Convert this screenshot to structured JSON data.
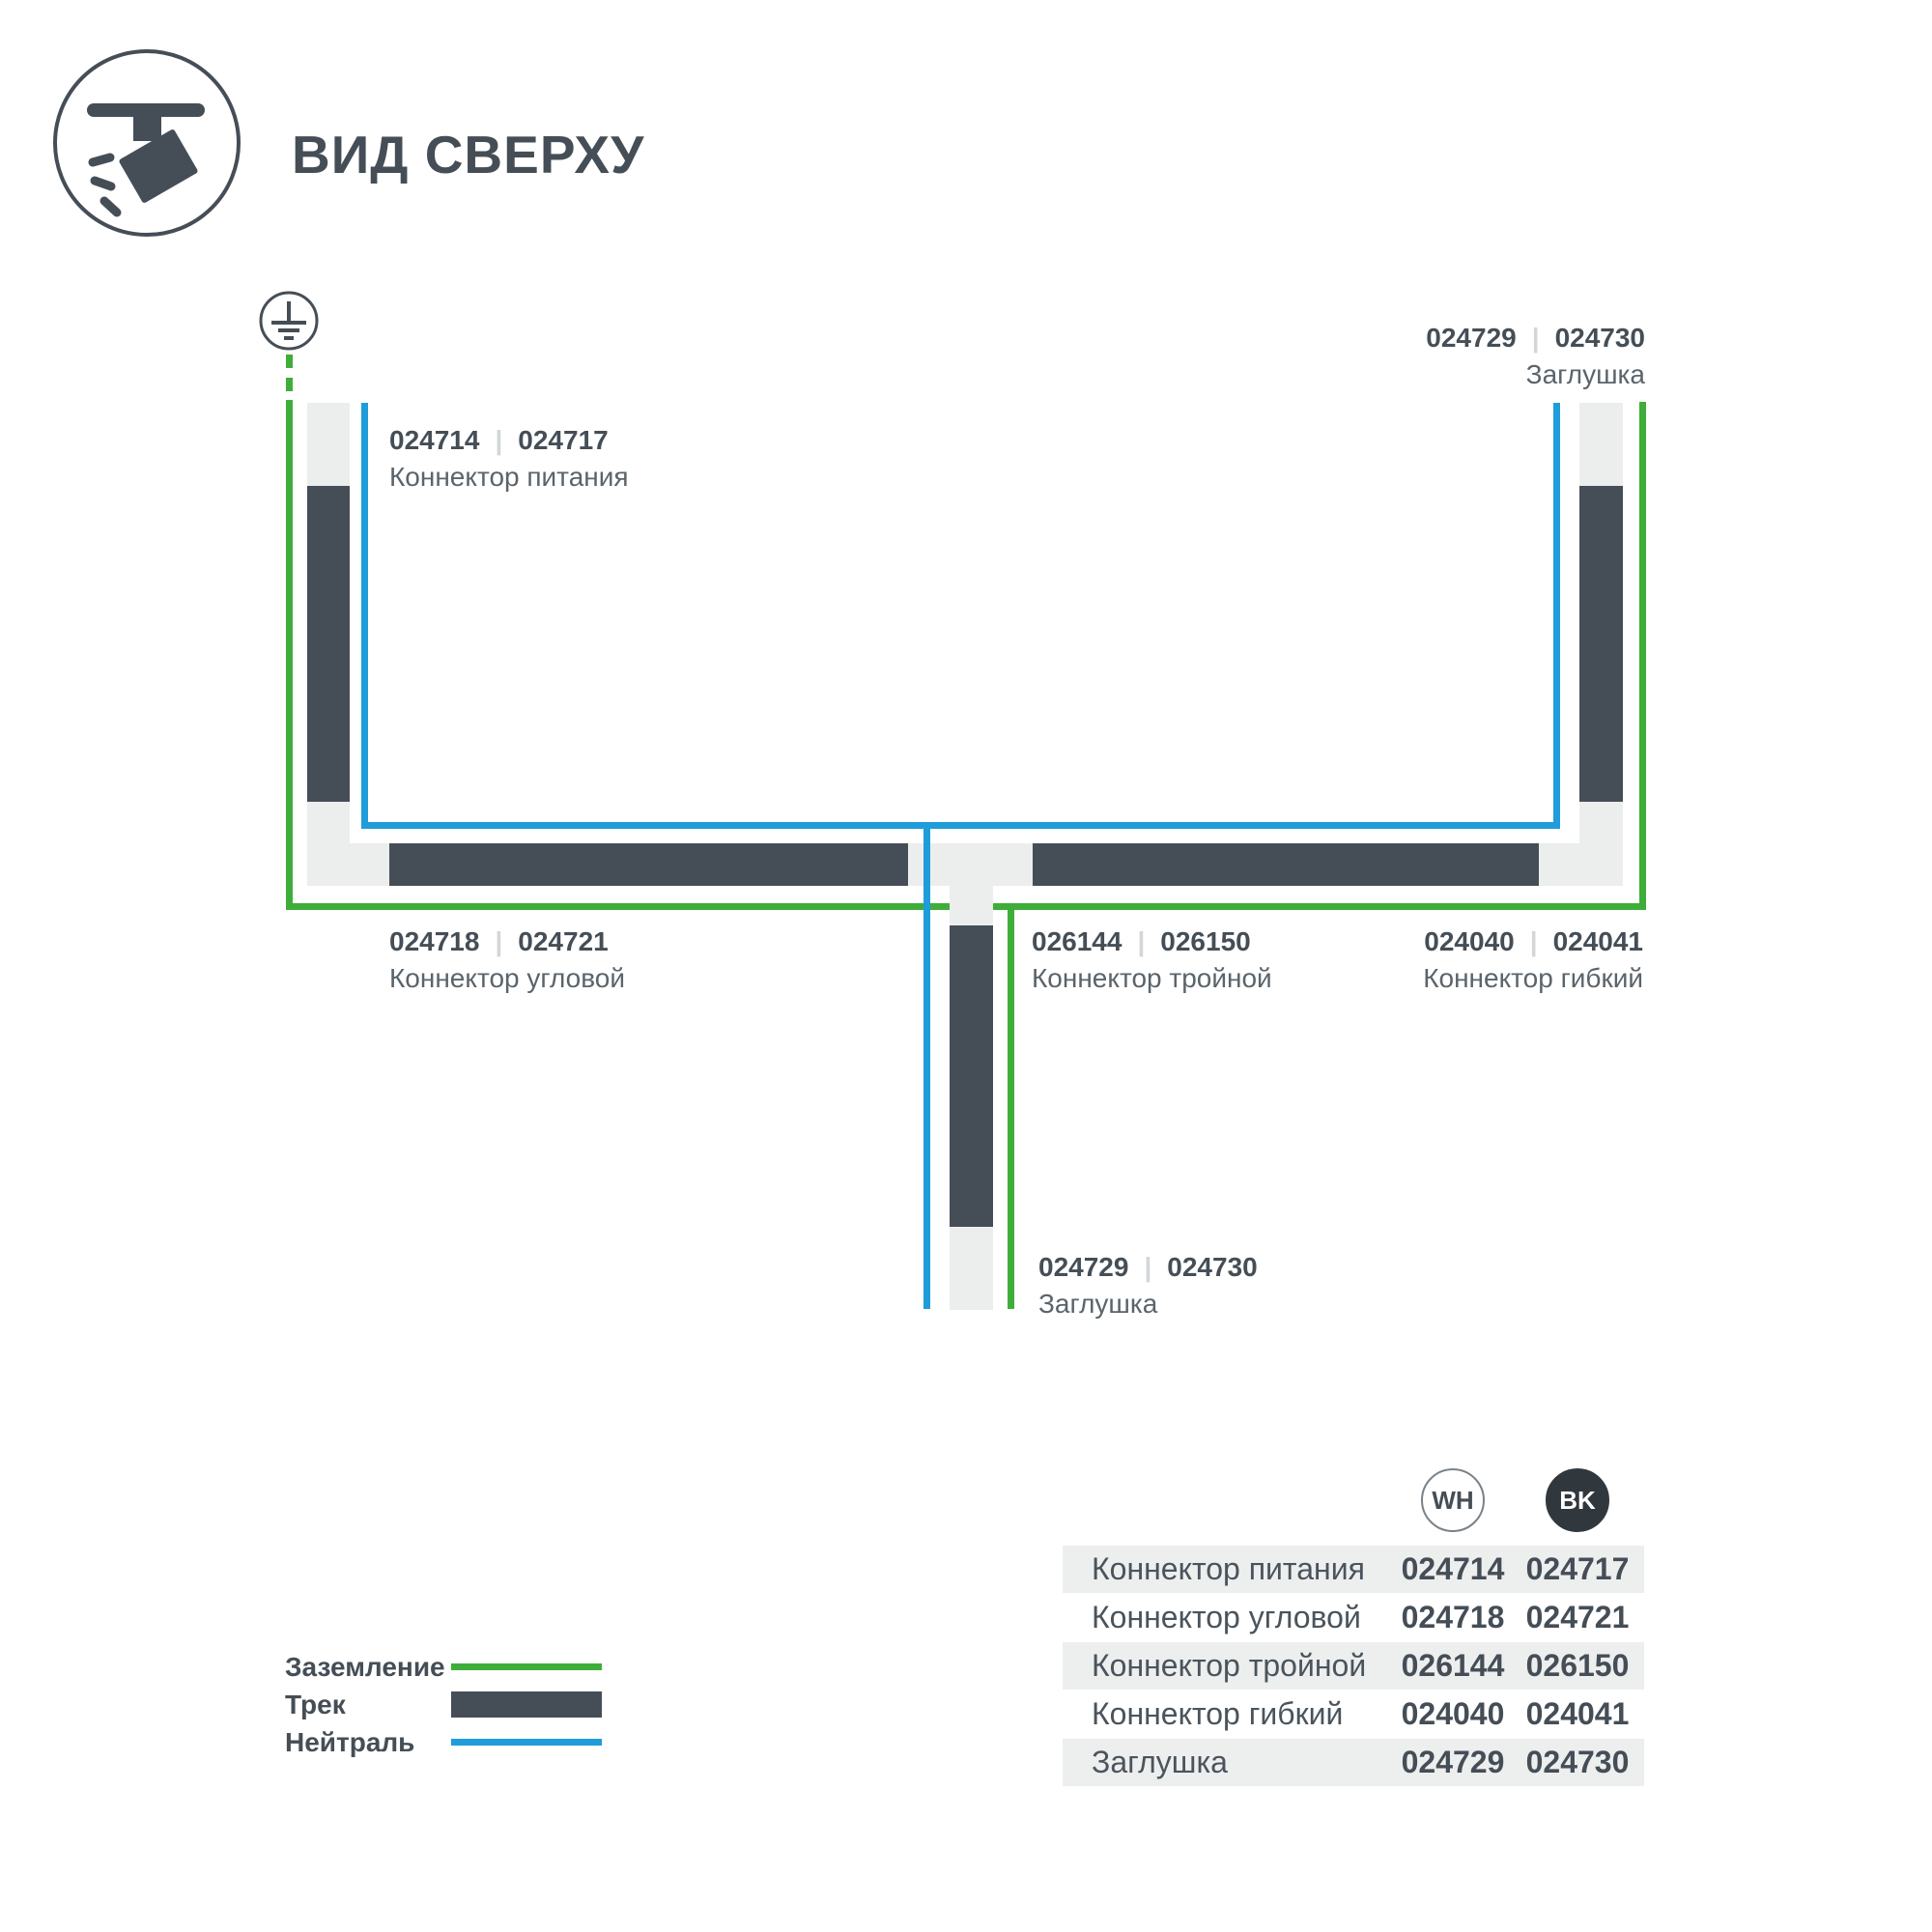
{
  "header": {
    "title": "ВИД СВЕРХУ"
  },
  "icons": {
    "header": "track-spotlight-icon",
    "ground": "ground-earth-icon"
  },
  "diagram": {
    "separator": "|",
    "labels": {
      "power": {
        "wh": "024714",
        "bk": "024717",
        "name": "Коннектор питания"
      },
      "cap_top": {
        "wh": "024729",
        "bk": "024730",
        "name": "Заглушка"
      },
      "corner": {
        "wh": "024718",
        "bk": "024721",
        "name": "Коннектор угловой"
      },
      "triple": {
        "wh": "026144",
        "bk": "026150",
        "name": "Коннектор тройной"
      },
      "flexible": {
        "wh": "024040",
        "bk": "024041",
        "name": "Коннектор гибкий"
      },
      "cap_bottom": {
        "wh": "024729",
        "bk": "024730",
        "name": "Заглушка"
      }
    }
  },
  "legend": {
    "items": [
      {
        "label": "Заземление",
        "swatch": "ground-line"
      },
      {
        "label": "Трек",
        "swatch": "track-bar"
      },
      {
        "label": "Нейтраль",
        "swatch": "neutral-line"
      }
    ]
  },
  "table": {
    "columns": [
      {
        "code": "WH"
      },
      {
        "code": "BK"
      }
    ],
    "rows": [
      {
        "name": "Коннектор питания",
        "wh": "024714",
        "bk": "024717"
      },
      {
        "name": "Коннектор угловой",
        "wh": "024718",
        "bk": "024721"
      },
      {
        "name": "Коннектор тройной",
        "wh": "026144",
        "bk": "026150"
      },
      {
        "name": "Коннектор гибкий",
        "wh": "024040",
        "bk": "024041"
      },
      {
        "name": "Заглушка",
        "wh": "024729",
        "bk": "024730"
      }
    ]
  },
  "colors": {
    "ground_green": "#3FAD3A",
    "neutral_blue": "#1F9CD9",
    "track_dark": "#454E56",
    "track_light": "#ECEDED",
    "table_row_gray": "#EDEEEE",
    "text_dark": "#454E56",
    "text_medium": "#5A646B"
  }
}
